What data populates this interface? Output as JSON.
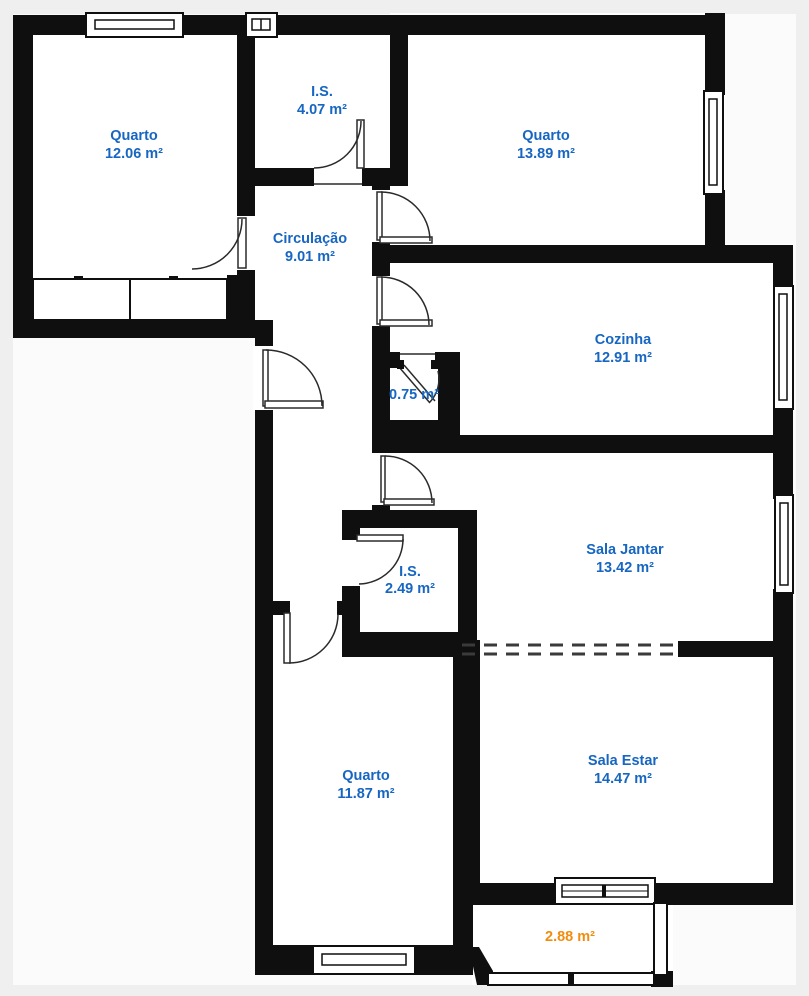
{
  "plan": {
    "title": "Apartment floor plan",
    "colors": {
      "wall": "#0f0f0f",
      "room_fill": "#ffffff",
      "outside": "#fbfbfb",
      "page_margin": "#f0eff0",
      "label_blue": "#1666c2",
      "label_orange": "#f28c0e",
      "door_line": "#2a2a2a"
    },
    "rooms": [
      {
        "id": "quarto-top-left",
        "name": "Quarto",
        "area": "12.06 m²"
      },
      {
        "id": "is-top",
        "name": "I.S.",
        "area": "4.07 m²"
      },
      {
        "id": "quarto-top-right",
        "name": "Quarto",
        "area": "13.89 m²"
      },
      {
        "id": "circulacao",
        "name": "Circulação",
        "area": "9.01 m²"
      },
      {
        "id": "cozinha",
        "name": "Cozinha",
        "area": "12.91 m²"
      },
      {
        "id": "closet-small",
        "name": "",
        "area": "0.75 m²"
      },
      {
        "id": "sala-jantar",
        "name": "Sala Jantar",
        "area": "13.42 m²"
      },
      {
        "id": "is-middle",
        "name": "I.S.",
        "area": "2.49 m²"
      },
      {
        "id": "quarto-bottom",
        "name": "Quarto",
        "area": "11.87 m²"
      },
      {
        "id": "sala-estar",
        "name": "Sala Estar",
        "area": "14.47 m²"
      },
      {
        "id": "varanda",
        "name": "",
        "area": "2.88 m²"
      }
    ]
  }
}
